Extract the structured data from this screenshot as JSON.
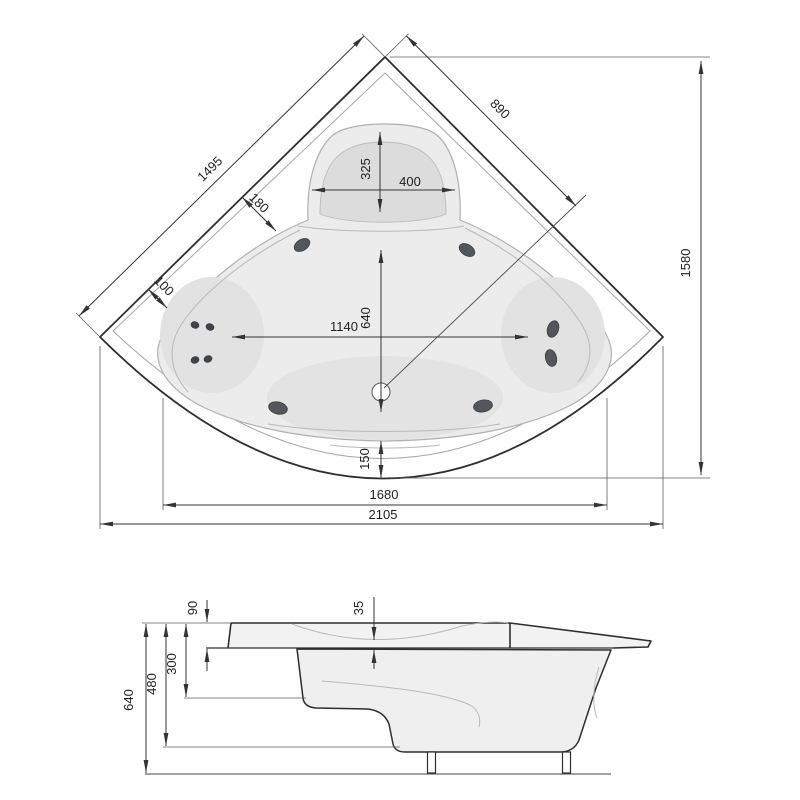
{
  "drawing": {
    "kind": "corner-bathtub-technical-drawing",
    "top_view": {
      "dims": {
        "edge_left": "1495",
        "edge_right": "890",
        "rim_width_diag": "180",
        "corner_gap": "100",
        "overall_depth": "1580",
        "headrest_depth": "325",
        "headrest_width": "400",
        "basin_width": "1140",
        "drain_offset": "640",
        "front_rim": "150",
        "front_inner_width": "1680",
        "overall_width": "2105"
      }
    },
    "side_view": {
      "dims": {
        "rim_thickness": "90",
        "deck_recess": "35",
        "upper_height": "300",
        "shell_height": "480",
        "total_height": "640"
      }
    },
    "colors": {
      "line": "#2e2e2e",
      "basin_fill": "#ececec",
      "shade_fill": "#e0e0e0",
      "seat_fill": "#dcdcdc",
      "body_fill": "#efefef",
      "jet_fill": "#53575c",
      "background": "#ffffff"
    }
  }
}
